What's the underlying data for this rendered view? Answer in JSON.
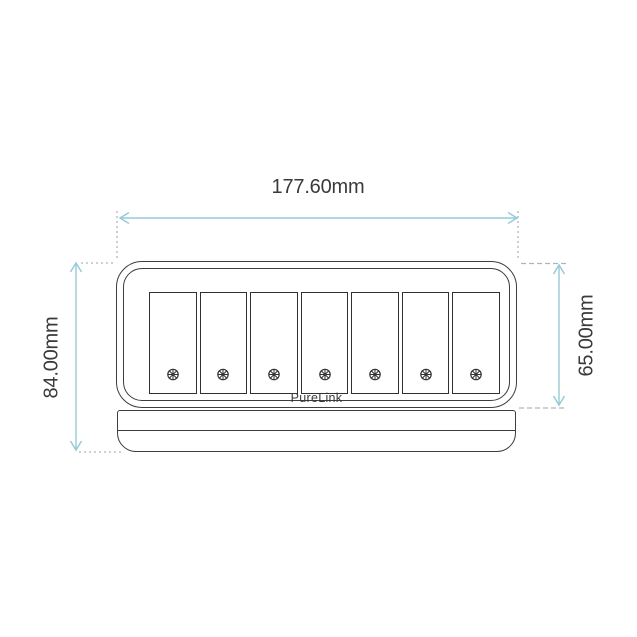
{
  "device": {
    "brand": "PureLink",
    "panel_count": 7
  },
  "dimensions": {
    "width": "177.60mm",
    "total_height": "84.00mm",
    "body_height": "65.00mm"
  },
  "icons": {
    "screw": "screw-head-icon"
  },
  "colors": {
    "dimension_arrow": "#97cbd8",
    "extension_line": "#b3b3b3",
    "outline": "#3d3d3d",
    "label_text": "#3a3a3a",
    "background": "#ffffff"
  }
}
